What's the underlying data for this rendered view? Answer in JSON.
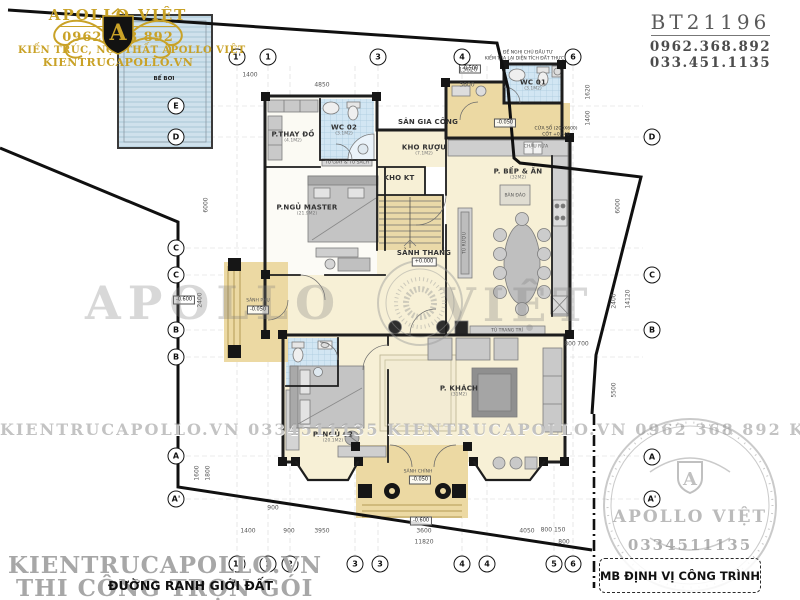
{
  "header": {
    "code": "BT21196",
    "phone1": "0962.368.892",
    "phone2": "033.451.1135"
  },
  "logo": {
    "monogram": "A",
    "brand": "APOLLO VIỆT",
    "phone": "0962 368 892",
    "line1": "KIẾN TRÚC, NỘI THẤT APOLLO VIỆT",
    "line2": "KIENTRUCAPOLLO.VN"
  },
  "colors": {
    "gold": "#c9a227",
    "wall": "#1d1d1d",
    "cream": "#f7f0d6",
    "tan": "#ecd9a3",
    "tile_blue": "#d2e6f3",
    "watermark_gray": "#9a9a9a"
  },
  "plan": {
    "rooms": [
      {
        "n": "P.THAY ĐỒ",
        "a": "(4.1M2)",
        "x": 293,
        "y": 137
      },
      {
        "n": "WC 02",
        "a": "(3.1M2)",
        "x": 344,
        "y": 130
      },
      {
        "n": "P.NGỦ MASTER",
        "a": "(21.9M2)",
        "x": 307,
        "y": 210
      },
      {
        "n": "KHO RƯỢU",
        "a": "(7.1M2)",
        "x": 424,
        "y": 150
      },
      {
        "n": "KHO KT",
        "a": "",
        "x": 399,
        "y": 178
      },
      {
        "n": "SÂN GIA CÔNG",
        "a": "",
        "x": 428,
        "y": 122
      },
      {
        "n": "WC 01",
        "a": "(3.1M2)",
        "x": 533,
        "y": 85
      },
      {
        "n": "P. BẾP & ĂN",
        "a": "(32M2)",
        "x": 518,
        "y": 174
      },
      {
        "n": "SẢNH THANG",
        "a": "",
        "x": 424,
        "y": 253
      },
      {
        "n": "P. KHÁCH",
        "a": "(31M2)",
        "x": 459,
        "y": 391
      },
      {
        "n": "P. NGỦ 02",
        "a": "(20.1M2)",
        "x": 333,
        "y": 437
      }
    ],
    "labels": [
      {
        "t": "BỂ BƠI",
        "x": 164,
        "y": 79,
        "b": 1
      },
      {
        "t": "BÀN ĐẢO",
        "x": 515,
        "y": 196
      },
      {
        "t": "TỦ RƯỢU",
        "x": 465,
        "y": 243,
        "r": 1
      },
      {
        "t": "TỦ TRANG TRÍ",
        "x": 507,
        "y": 331
      },
      {
        "t": "TỦ GIÀY & TỦ SÁCH",
        "x": 347,
        "y": 163
      },
      {
        "t": "CHẬU RỬA",
        "x": 536,
        "y": 147
      },
      {
        "t": "SẢNH CHÍNH",
        "x": 418,
        "y": 472
      },
      {
        "t": "SẢNH PHỤ",
        "x": 258,
        "y": 301
      }
    ],
    "elevations": [
      {
        "t": "-0.500",
        "x": 470,
        "y": 69
      },
      {
        "t": "-0.050",
        "x": 505,
        "y": 123
      },
      {
        "t": "+0.000",
        "x": 424,
        "y": 262
      },
      {
        "t": "-0.050",
        "x": 258,
        "y": 310
      },
      {
        "t": "-0.050",
        "x": 420,
        "y": 480
      },
      {
        "t": "-0.600",
        "x": 421,
        "y": 521
      },
      {
        "t": "-0.600",
        "x": 184,
        "y": 300
      }
    ],
    "notes": [
      {
        "t": "ĐỀ NGHỊ CHỦ ĐẦU TƯ",
        "x": 528,
        "y": 53
      },
      {
        "t": "KIỂM TRA LẠI DIỆN TÍCH ĐẤT THỰC TẾ",
        "x": 528,
        "y": 59
      },
      {
        "t": "CỬA SỔ (200X600)",
        "x": 556,
        "y": 129
      },
      {
        "t": "CỐT +0.840",
        "x": 556,
        "y": 135
      }
    ],
    "dims": [
      {
        "t": "1400",
        "x": 250,
        "y": 75
      },
      {
        "t": "13620",
        "x": 468,
        "y": 70
      },
      {
        "t": "4850",
        "x": 322,
        "y": 85
      },
      {
        "t": "3600",
        "x": 467,
        "y": 85
      },
      {
        "t": "1620",
        "x": 588,
        "y": 92,
        "r": 1
      },
      {
        "t": "1400",
        "x": 588,
        "y": 118,
        "r": 1
      },
      {
        "t": "6000",
        "x": 618,
        "y": 206,
        "r": 1
      },
      {
        "t": "2400",
        "x": 614,
        "y": 301,
        "r": 1
      },
      {
        "t": "14120",
        "x": 628,
        "y": 299,
        "r": 1
      },
      {
        "t": "5500",
        "x": 614,
        "y": 390,
        "r": 1
      },
      {
        "t": "800",
        "x": 570,
        "y": 344
      },
      {
        "t": "700",
        "x": 583,
        "y": 344
      },
      {
        "t": "6000",
        "x": 206,
        "y": 205,
        "r": 1
      },
      {
        "t": "2400",
        "x": 200,
        "y": 300,
        "r": 1
      },
      {
        "t": "1600",
        "x": 197,
        "y": 473,
        "r": 1
      },
      {
        "t": "1800",
        "x": 208,
        "y": 473,
        "r": 1
      },
      {
        "t": "900",
        "x": 273,
        "y": 508
      },
      {
        "t": "1400",
        "x": 248,
        "y": 531
      },
      {
        "t": "900",
        "x": 289,
        "y": 531
      },
      {
        "t": "3950",
        "x": 322,
        "y": 531
      },
      {
        "t": "3600",
        "x": 424,
        "y": 531
      },
      {
        "t": "4050",
        "x": 527,
        "y": 531
      },
      {
        "t": "11820",
        "x": 424,
        "y": 542
      },
      {
        "t": "800 150",
        "x": 553,
        "y": 530
      },
      {
        "t": "800",
        "x": 564,
        "y": 542
      }
    ],
    "bubbles": [
      {
        "t": "1'",
        "x": 237,
        "y": 57
      },
      {
        "t": "1",
        "x": 268,
        "y": 57
      },
      {
        "t": "3",
        "x": 378,
        "y": 57
      },
      {
        "t": "4",
        "x": 462,
        "y": 57
      },
      {
        "t": "6",
        "x": 573,
        "y": 57
      },
      {
        "t": "1'",
        "x": 237,
        "y": 564
      },
      {
        "t": "1",
        "x": 268,
        "y": 564
      },
      {
        "t": "2",
        "x": 290,
        "y": 564
      },
      {
        "t": "3",
        "x": 355,
        "y": 564
      },
      {
        "t": "3",
        "x": 380,
        "y": 564
      },
      {
        "t": "4",
        "x": 462,
        "y": 564
      },
      {
        "t": "4",
        "x": 487,
        "y": 564
      },
      {
        "t": "5",
        "x": 554,
        "y": 564
      },
      {
        "t": "6",
        "x": 573,
        "y": 564
      },
      {
        "t": "E",
        "x": 176,
        "y": 106
      },
      {
        "t": "D",
        "x": 176,
        "y": 137
      },
      {
        "t": "C",
        "x": 176,
        "y": 248
      },
      {
        "t": "C",
        "x": 176,
        "y": 275
      },
      {
        "t": "B",
        "x": 176,
        "y": 330
      },
      {
        "t": "B",
        "x": 176,
        "y": 357
      },
      {
        "t": "A",
        "x": 176,
        "y": 456
      },
      {
        "t": "A'",
        "x": 176,
        "y": 499
      },
      {
        "t": "D",
        "x": 652,
        "y": 137
      },
      {
        "t": "C",
        "x": 652,
        "y": 275
      },
      {
        "t": "B",
        "x": 652,
        "y": 330
      },
      {
        "t": "A",
        "x": 652,
        "y": 457
      },
      {
        "t": "A'",
        "x": 652,
        "y": 499
      }
    ]
  },
  "watermarks": {
    "strip": "KIENTRUCAPOLLO.VN   0334511135   KIENTRUCAPOLLO.VN   0962 368 892   KIENTRUCAPOLLO.VN   0334511135",
    "big_left": "APOLLO",
    "big_right": "VIỆT",
    "bottom_site": "KIENTRUCAPOLLO.VN",
    "bottom_slogan": "THI CÔNG TRỌN GÓI",
    "stamp_brand": "APOLLO VIỆT",
    "stamp_monogram": "A",
    "stamp_phone": "0334511135"
  },
  "footer": {
    "boundary_label": "ĐƯỜNG RANH GIỚI ĐẤT",
    "title_box": "MB ĐỊNH VỊ CÔNG TRÌNH"
  }
}
